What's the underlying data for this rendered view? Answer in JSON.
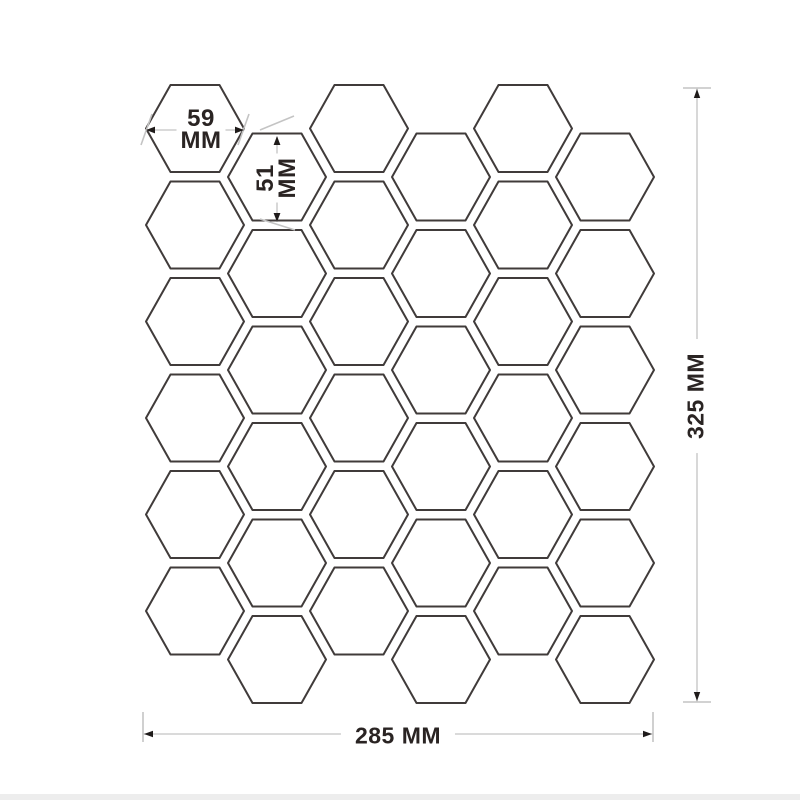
{
  "annotations": {
    "hex_width": {
      "line1": "59",
      "line2": "MM"
    },
    "hex_height": {
      "line1": "51",
      "line2": "MM"
    },
    "sheet_height": {
      "label": "325 MM"
    },
    "sheet_width": {
      "label": "285 MM"
    }
  },
  "pattern": {
    "type": "hexagon-honeycomb-flat-top",
    "columns": 6,
    "hexes_per_column": 6,
    "hex_width_px": 98,
    "hex_height_px": 87,
    "column_pitch_px": 82,
    "vertical_pitch_px": 96.5,
    "first_column_center_x": 195,
    "even_column_first_center_y": 128.5,
    "odd_column_offset_px": 48.5
  },
  "colors": {
    "background": "#ffffff",
    "hex_stroke": "#403b3a",
    "dim_line": "#c4c4c4",
    "arrow": "#1f1b1a",
    "dim_text": "#2a2423",
    "footer_band": "#ededed"
  }
}
